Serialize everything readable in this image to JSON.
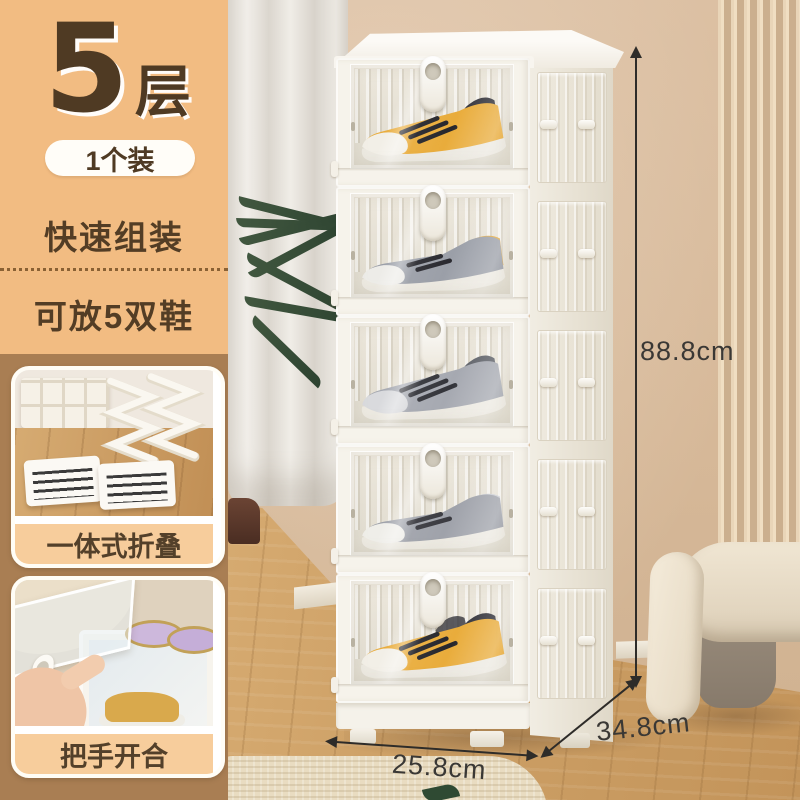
{
  "panel": {
    "tier_number": "5",
    "tier_unit": "层",
    "pack_label": "1个装",
    "feature_quick": "快速组装",
    "feature_capacity": "可放5双鞋",
    "thumb1_caption": "一体式折叠",
    "thumb2_caption": "把手开合"
  },
  "dimensions": {
    "height_label": "88.8cm",
    "depth_label": "34.8cm",
    "width_label": "25.8cm"
  },
  "product": {
    "description": "5-tier foldable stackable shoe storage box with clear magnetic front doors and oval pull handles",
    "layers": [
      {
        "position": 1,
        "shoe": "yellow-black high-top sneaker"
      },
      {
        "position": 2,
        "shoe": "grey runner with yellow heel accent"
      },
      {
        "position": 3,
        "shoe": "grey high-top sneaker"
      },
      {
        "position": 4,
        "shoe": "grey-white runner"
      },
      {
        "position": 5,
        "shoe": "yellow-white high-top sneaker pair"
      }
    ]
  },
  "palette": {
    "panel_bg": "#F2BC82",
    "panel_column_bg": "#A97E53",
    "text_brown": "#4F3A23",
    "pill_bg": "#FFFDF8",
    "caption_bg": "#F7CD9C",
    "arrow_color": "#2E2C29",
    "cabinet_white": "#F6F3EB",
    "wall": "#D8BB9D",
    "floor_wood": "#CDA066",
    "shoe_yellow": "#E9AC3B",
    "shoe_grey": "#9B9FA8"
  }
}
